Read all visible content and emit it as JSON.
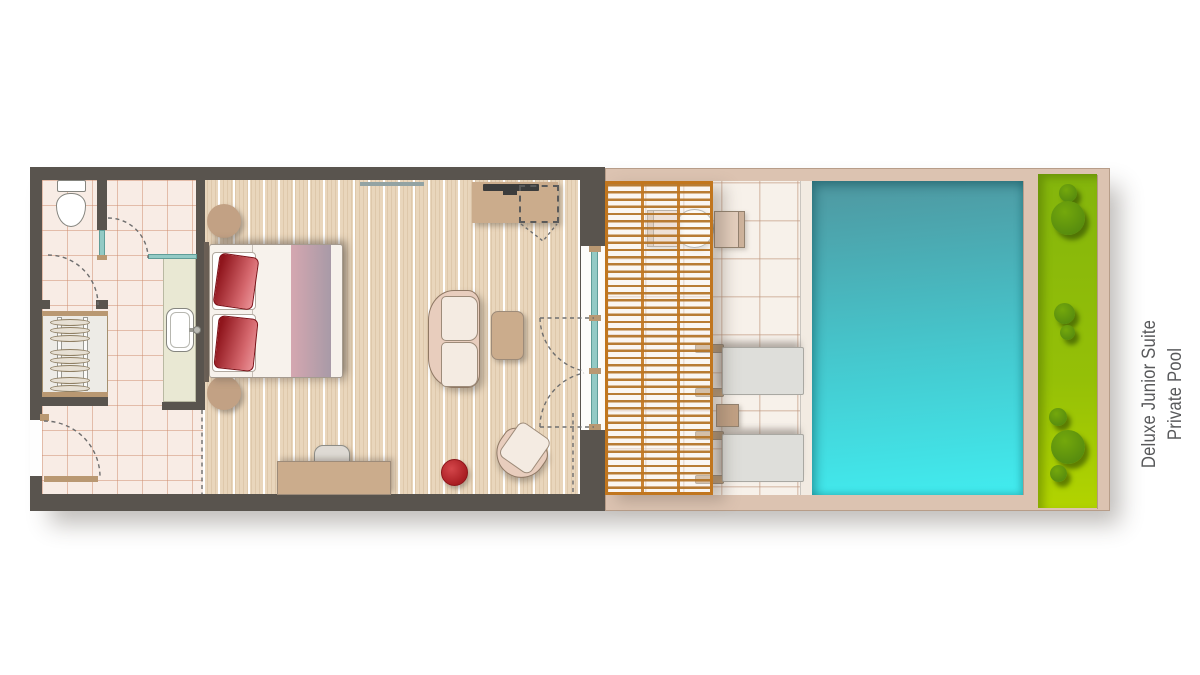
{
  "page": {
    "background": "#ffffff"
  },
  "label": {
    "text": "Deluxe Junior Suite Private Pool"
  },
  "palette": {
    "wall-dark": "#59544e",
    "tile-bg": "#f8ece5",
    "tile-line": "rgba(205,140,110,0.5)",
    "wood-bg": "#e9d6bc",
    "vanity": "#e9e8d3",
    "glass": "#93cac5",
    "glass-edge": "#5f9d98",
    "door-tan": "#b99872",
    "furn-tan": "#cbac8c",
    "night-tan": "#c2a184",
    "furn-border": "#8f7864",
    "sofa-frame": "#e8cdbd",
    "cushion": "#f4ebe2",
    "bed-white": "#f7f2ec",
    "runner-left": "#d5a7b0",
    "runner-right": "#a89aa7",
    "pillow-dark": "#8f151c",
    "pillow-light": "#ea9297",
    "accent-red": "#b5262a",
    "outdoor-wall": "#dcc3b1",
    "outdoor-edge": "#b79d89",
    "terrace-tile": "#f7f1ea",
    "terrace-line": "rgba(190,150,125,0.45)",
    "pergola": "#c1761e",
    "pool-top": "#4f97a0",
    "pool-mid": "#45c8ce",
    "pool-bottom": "#41ecef",
    "lawn-top": "#84b50c",
    "lawn-bottom": "#b2d400",
    "bush": "#578c0e",
    "bush-light": "#74a80c",
    "lounger": "#dededa",
    "grey-furn": "#dedad4",
    "label-color": "#58595b"
  },
  "floorplan": {
    "rooms": [
      {
        "name": "bathroom"
      },
      {
        "name": "bedroom-living"
      },
      {
        "name": "covered-terrace"
      },
      {
        "name": "private-pool"
      },
      {
        "name": "garden-border"
      }
    ],
    "fixtures": [
      "toilet",
      "vanity-washbasin",
      "wardrobe",
      "double-bed",
      "nightstands",
      "tv-console",
      "sofa",
      "coffee-table",
      "armchair",
      "red-pouf",
      "desk",
      "desk-chair",
      "sliding-glass-doors",
      "pergola",
      "outdoor-dining-table",
      "outdoor-chairs",
      "sun-loungers",
      "side-table",
      "garden-bushes"
    ]
  }
}
